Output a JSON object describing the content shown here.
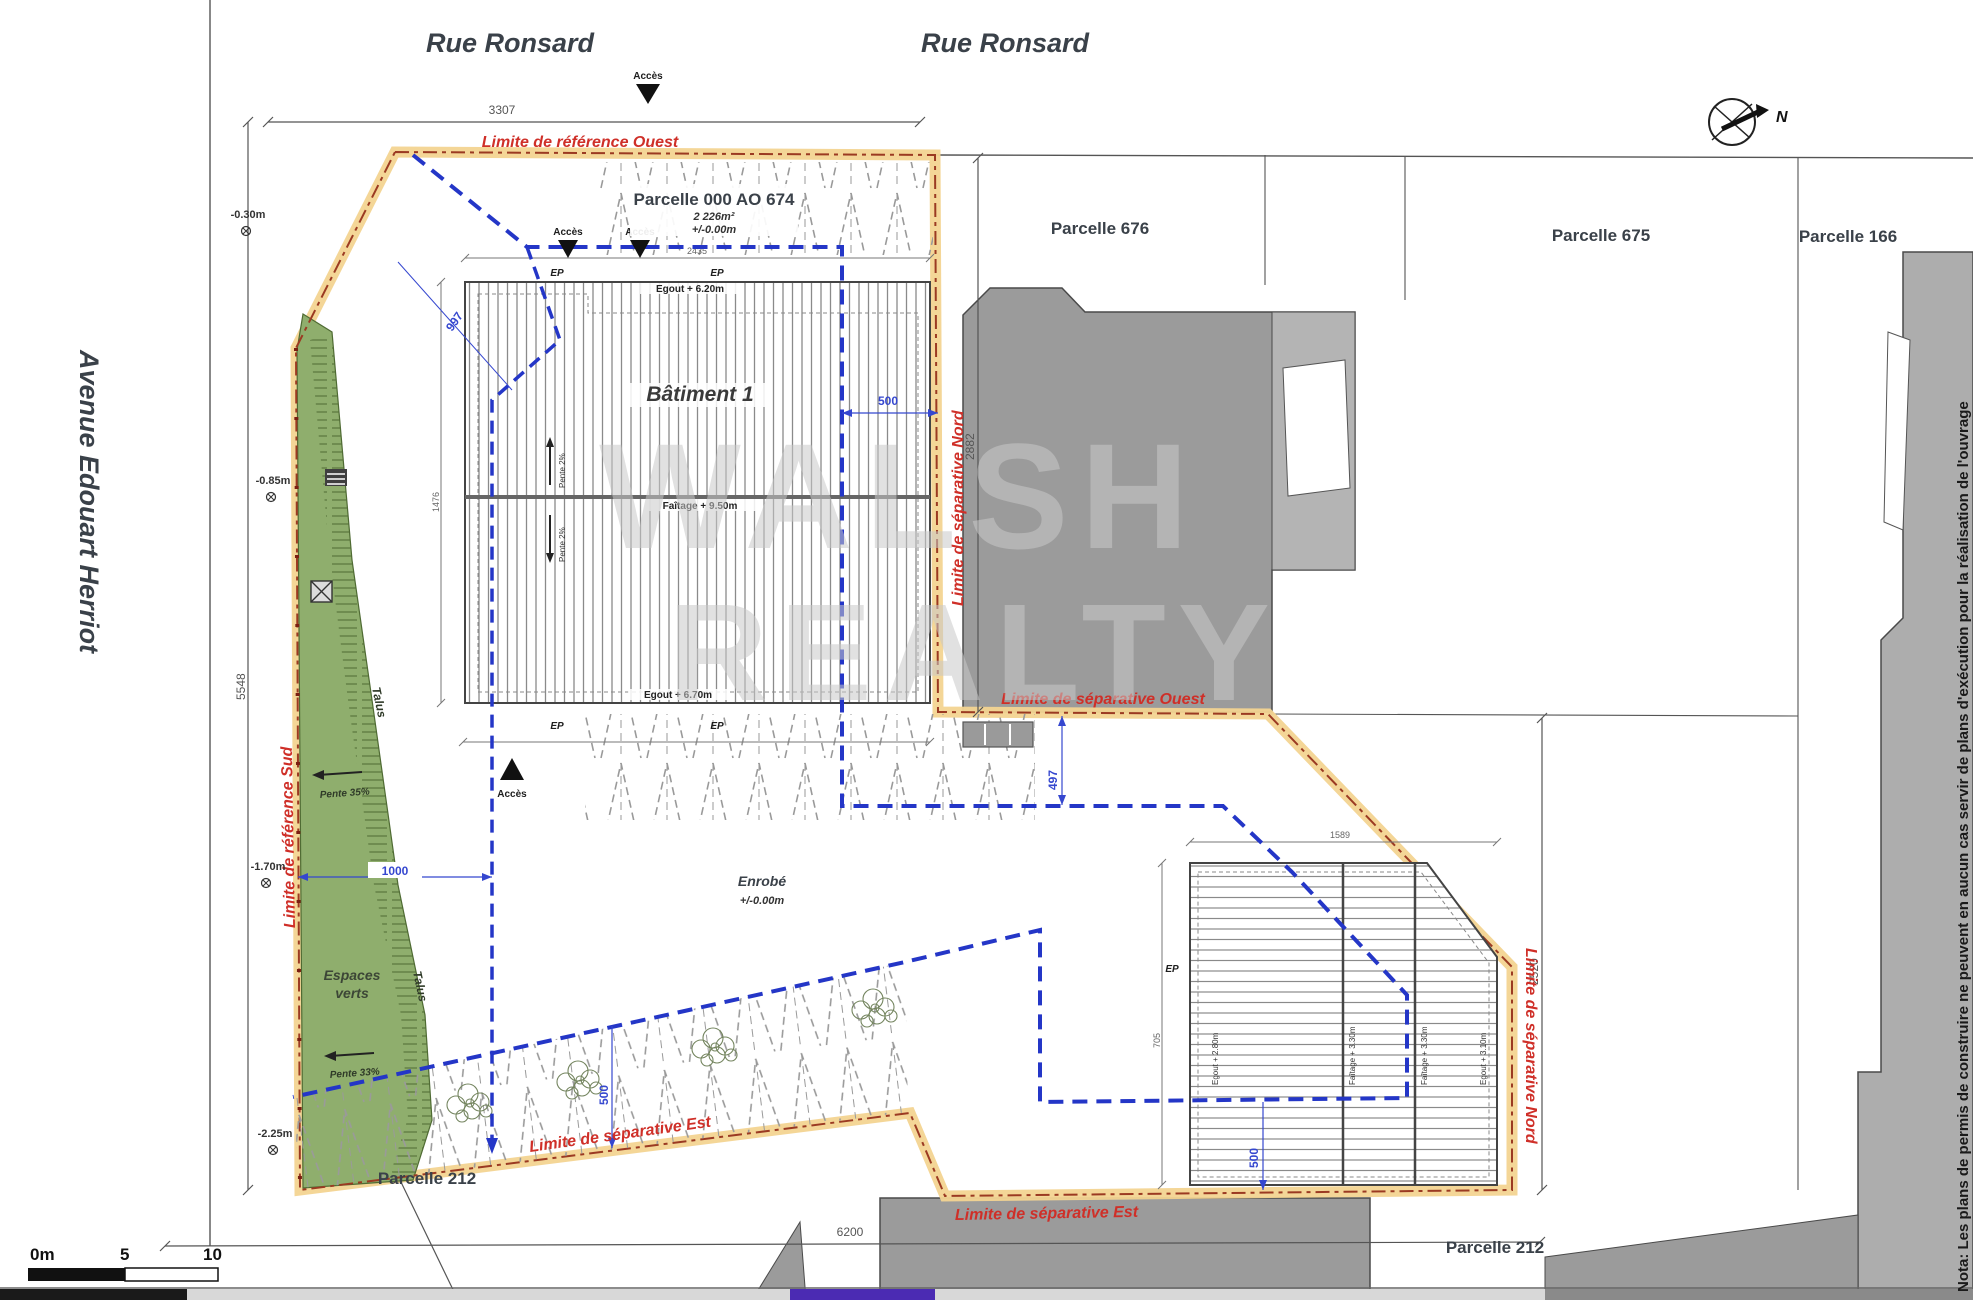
{
  "streets": {
    "top_left": "Rue Ronsard",
    "top_right": "Rue Ronsard",
    "left": "Avenue Edouart Herriot"
  },
  "parcels": {
    "main": "Parcelle 000 AO 674",
    "main_area": "2 226m²",
    "main_level": "+/-0.00m",
    "p676": "Parcelle 676",
    "p675": "Parcelle 675",
    "p166": "Parcelle 166",
    "p212": "Parcelle 212"
  },
  "buildings": {
    "b1": "Bâtiment 1",
    "b1_faitage": "Faîtage + 9.50m",
    "b1_egout_top": "Egout + 6.20m",
    "b1_egout_bottom": "Egout + 6.70m",
    "b1_pente": "Pente 2%",
    "b2_egout_left": "Egout + 2.80m",
    "b2_faitage": "Faîtage + 3.30m",
    "b2_egout_right": "Egout + 3.10m"
  },
  "limits": {
    "ref_ouest": "Limite de référence Ouest",
    "ref_sud": "Limite de référence Sud",
    "sep_nord": "Limite de séparative Nord",
    "sep_ouest": "Limite de séparative Ouest",
    "sep_est": "Limite de séparative Est"
  },
  "site": {
    "espaces_1": "Espaces",
    "espaces_2": "verts",
    "talus": "Talus",
    "pente35": "Pente 35%",
    "pente33": "Pente 33%",
    "enrobe": "Enrobé",
    "enrobe_level": "+/-0.00m",
    "acces": "Accès",
    "ep": "EP"
  },
  "levels": {
    "a": "-0.30m",
    "b": "-0.85m",
    "c": "-1.70m",
    "d": "-2.25m"
  },
  "dims": {
    "d3307": "3307",
    "d5548": "5548",
    "d2882": "2882",
    "d2520": "2520",
    "d6200": "6200",
    "d1000": "1000",
    "d500": "500",
    "d497": "497",
    "d997": "997",
    "d1589": "1589",
    "d705": "705",
    "d2435": "2435",
    "d1476": "1476"
  },
  "compass": {
    "north": "N"
  },
  "scalebar": {
    "zero": "0m",
    "five": "5",
    "ten": "10"
  },
  "note": "Nota: Les plans de permis de construire ne peuvent en aucun cas servir de plans d'exécution pour la réalisation de l'ouvrage",
  "watermark": {
    "line1": "WALSH",
    "line2": "REALTY"
  },
  "colors": {
    "limit_red": "#cf2f28",
    "boundary_band": "#f3d491",
    "boundary_edge": "#9b3a22",
    "utility_blue": "#2436c7",
    "dim_blue": "#3547cf",
    "green": "#8fae6d",
    "green_dark": "#4f6b33",
    "building_gray": "#9b9b9b",
    "building_gray_light": "#b4b4b4",
    "text_dark": "#3a4149"
  }
}
